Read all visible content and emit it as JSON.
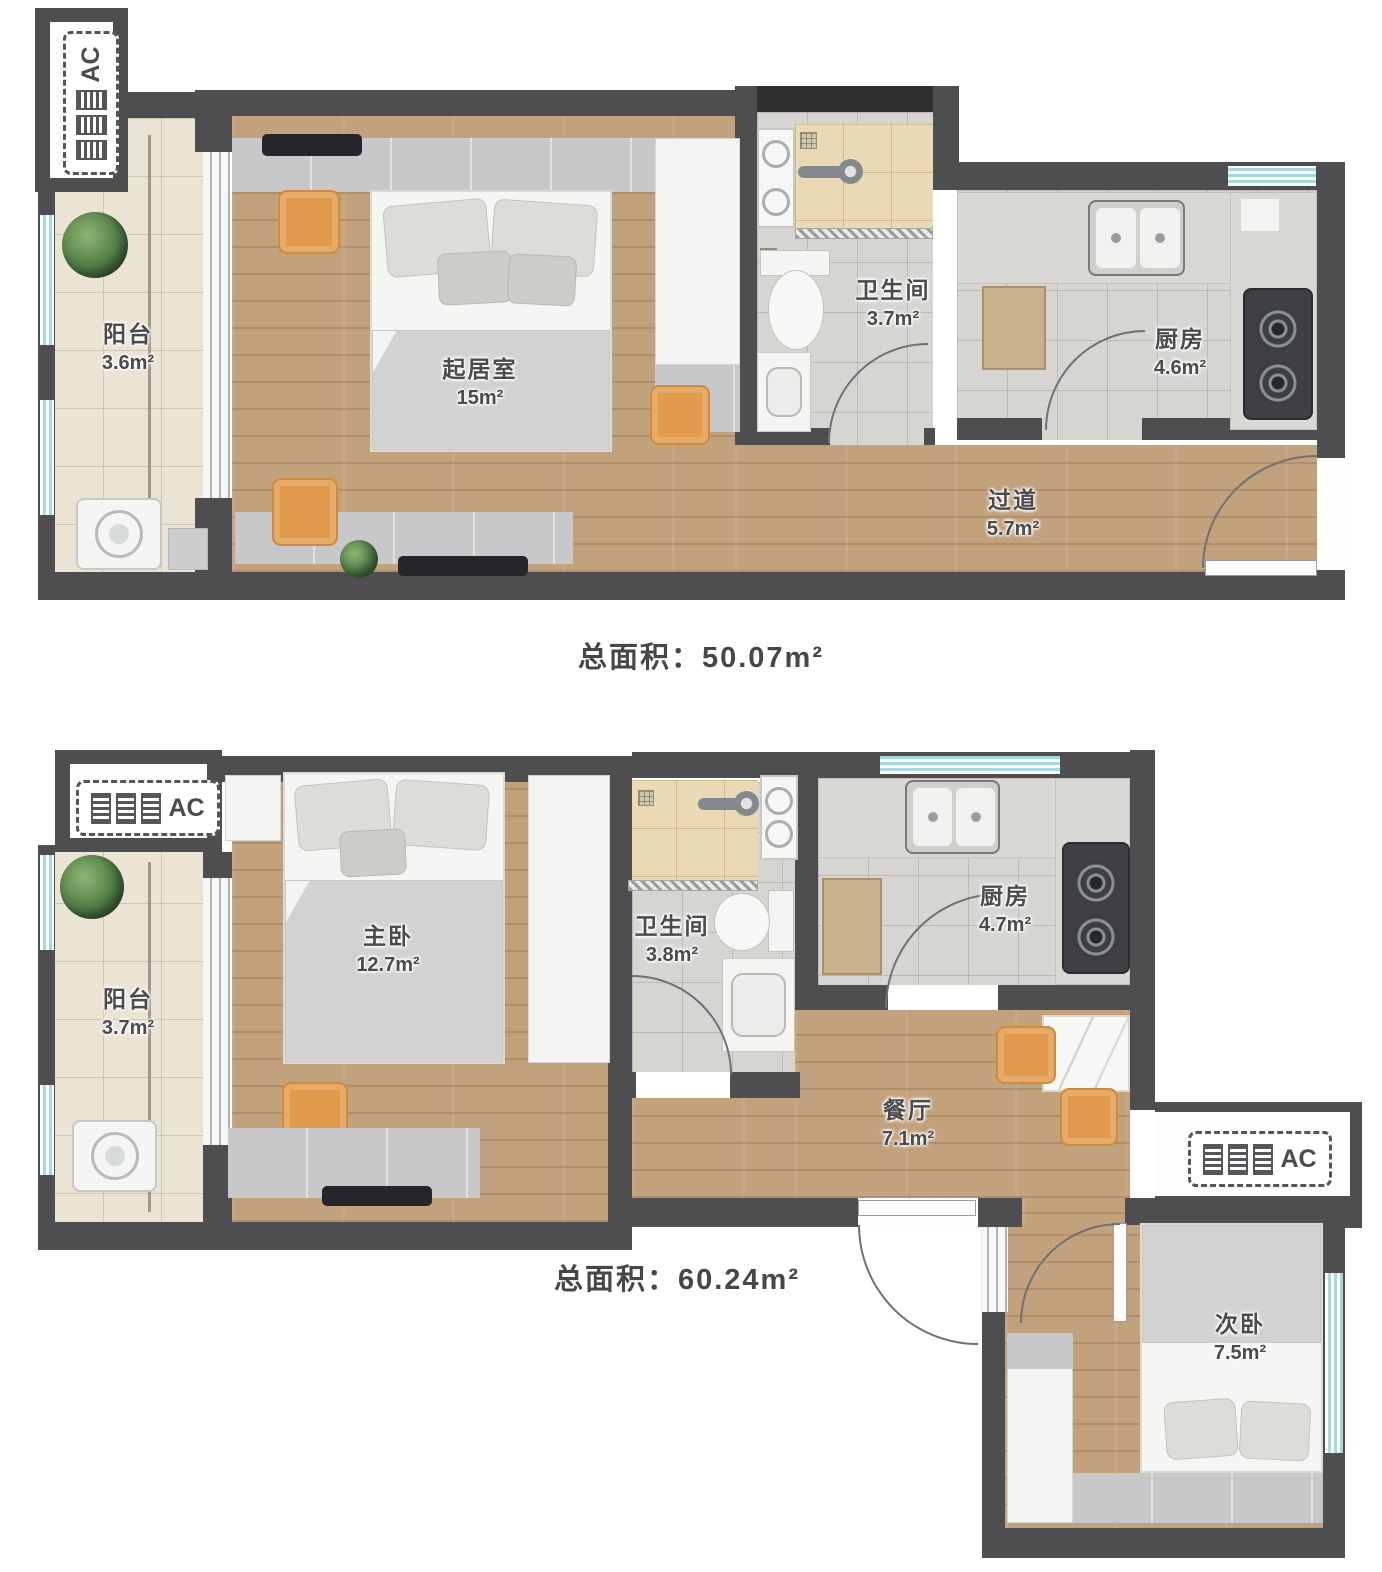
{
  "palette": {
    "wall": "#4e4e50",
    "wall_dark": "#2f2f31",
    "wood_floor": "#c2a17d",
    "tile_cream": "#ebe4d4",
    "tile_beige": "#e9d9b4",
    "tile_grey": "#d7d5d1",
    "accent_orange": "#e29a4d",
    "window_glass": "#a8d8de"
  },
  "labels": {
    "ac": "AC"
  },
  "plan_a": {
    "total": "总面积：50.07m²",
    "rooms": {
      "balcony": {
        "name": "阳台",
        "area": "3.6m²"
      },
      "living": {
        "name": "起居室",
        "area": "15m²"
      },
      "bathroom": {
        "name": "卫生间",
        "area": "3.7m²"
      },
      "kitchen": {
        "name": "厨房",
        "area": "4.6m²"
      },
      "hallway": {
        "name": "过道",
        "area": "5.7m²"
      }
    }
  },
  "plan_b": {
    "total": "总面积：60.24m²",
    "rooms": {
      "balcony": {
        "name": "阳台",
        "area": "3.7m²"
      },
      "master": {
        "name": "主卧",
        "area": "12.7m²"
      },
      "bathroom": {
        "name": "卫生间",
        "area": "3.8m²"
      },
      "kitchen": {
        "name": "厨房",
        "area": "4.7m²"
      },
      "dining": {
        "name": "餐厅",
        "area": "7.1m²"
      },
      "secondary": {
        "name": "次卧",
        "area": "7.5m²"
      }
    }
  }
}
